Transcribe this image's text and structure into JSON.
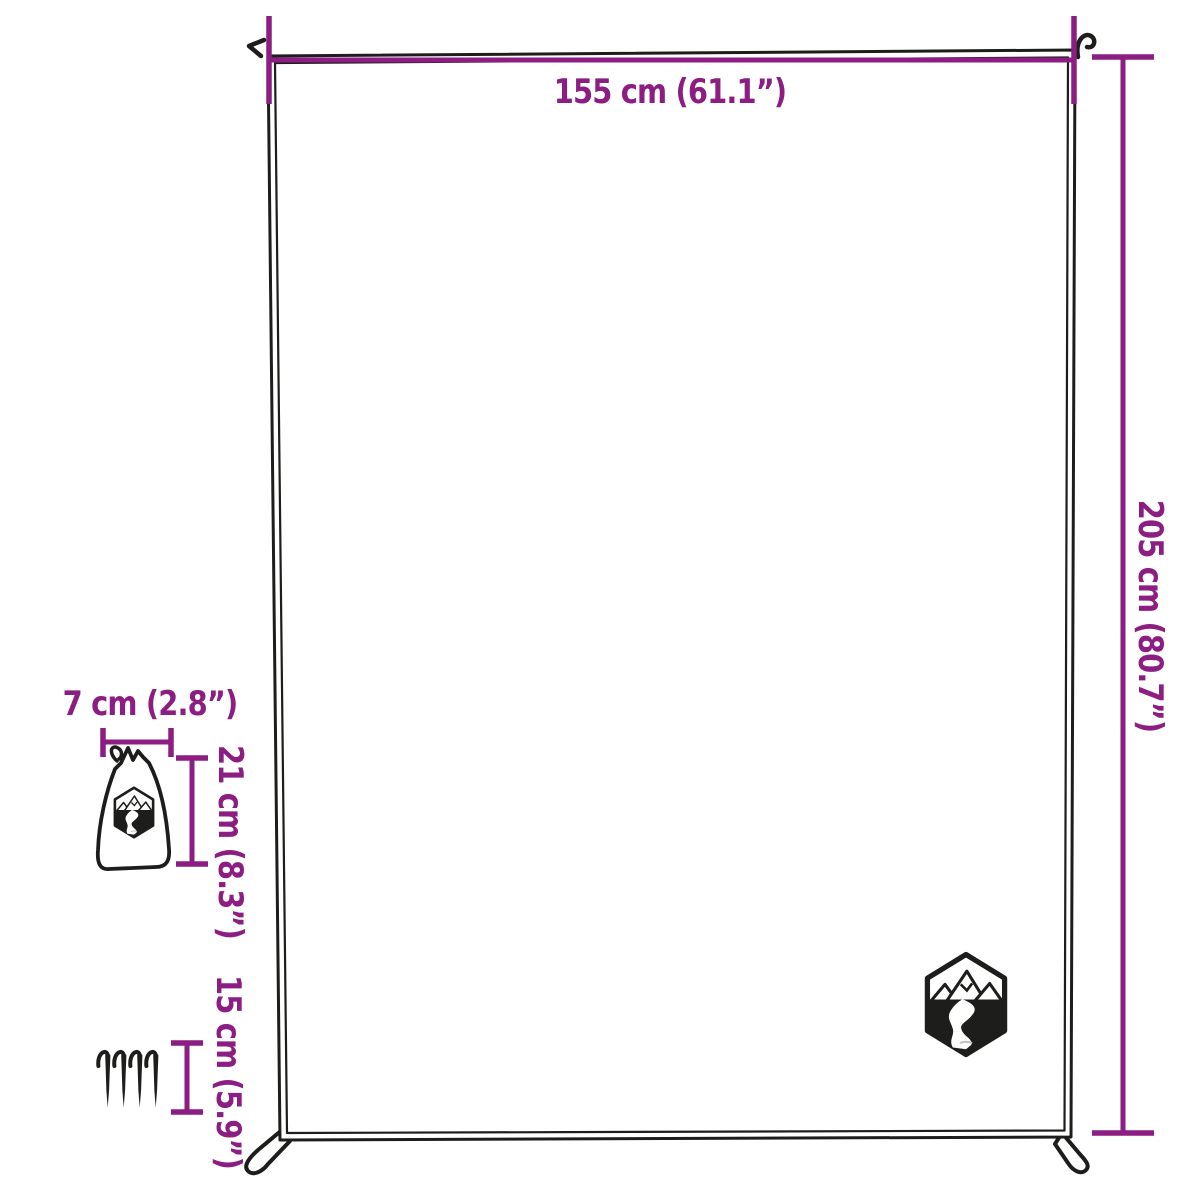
{
  "diagram": {
    "type": "product-dimension-diagram",
    "product": "picnic blanket with carry bag and tent pegs",
    "colors": {
      "accent": "#8c1d82",
      "line": "#1d1d1b",
      "background": "#ffffff"
    },
    "labels": {
      "blanket_width": "155 cm (61.1”)",
      "blanket_height": "205 cm (80.7”)",
      "bag_width": "7 cm (2.8”)",
      "bag_height": "21 cm (8.3”)",
      "peg_length": "15 cm (5.9”)"
    },
    "icons": {
      "logo": "mountain-river-hexagon-logo",
      "bag": "drawstring-bag-icon",
      "peg": "tent-peg-icon"
    },
    "pegs": {
      "count": 4
    }
  }
}
